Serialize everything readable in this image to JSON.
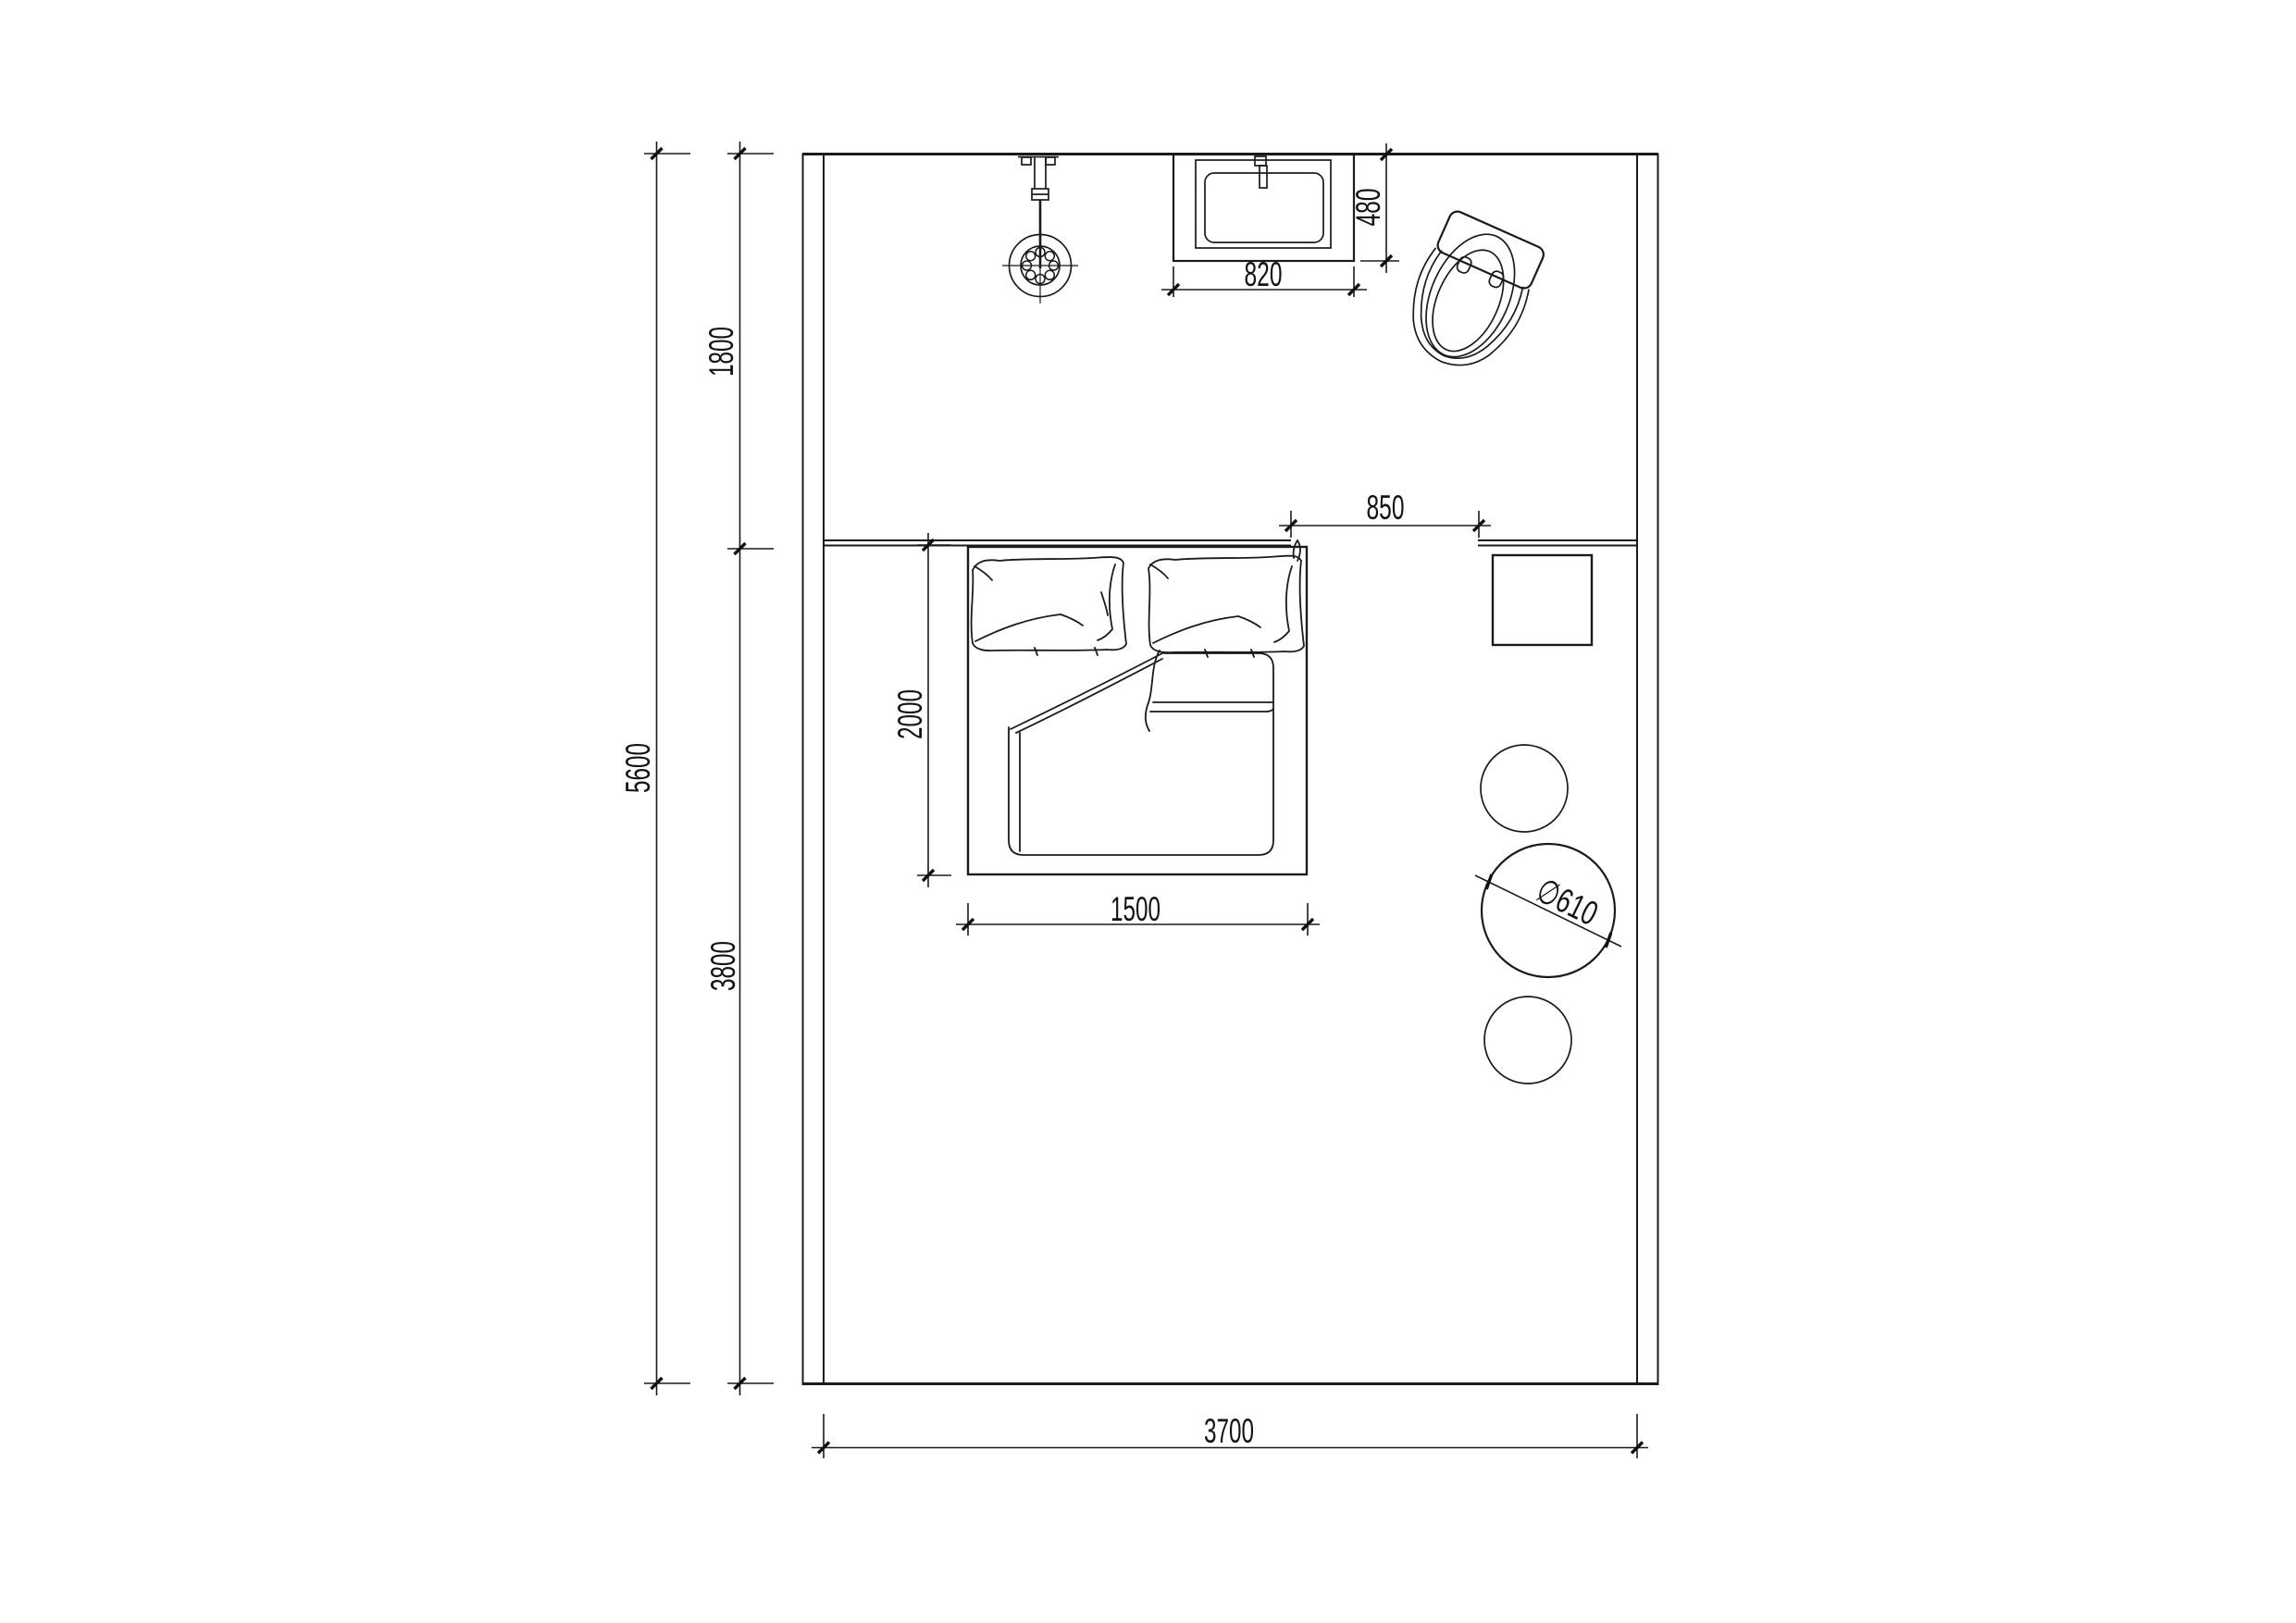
{
  "drawing": {
    "type": "bedroom-floor-plan",
    "dimensions": {
      "overall_depth": "5600",
      "bathroom_zone_depth": "1800",
      "bedroom_zone_depth": "3800",
      "overall_width": "3700",
      "bed_length": "2000",
      "bed_width": "1500",
      "passage_opening": "850",
      "basin_width": "820",
      "basin_depth": "480",
      "table_diameter": "∅610"
    },
    "symbols": {
      "shower": "shower-head-symbol",
      "basin": "washbasin-vanity-symbol",
      "toilet": "toilet-symbol",
      "bed": "double-bed-symbol",
      "nightstand": "nightstand-symbol",
      "table": "round-table-symbol",
      "stool": "stool-symbol"
    },
    "colors": {
      "line": "#1b1b1b",
      "background": "#ffffff"
    }
  }
}
